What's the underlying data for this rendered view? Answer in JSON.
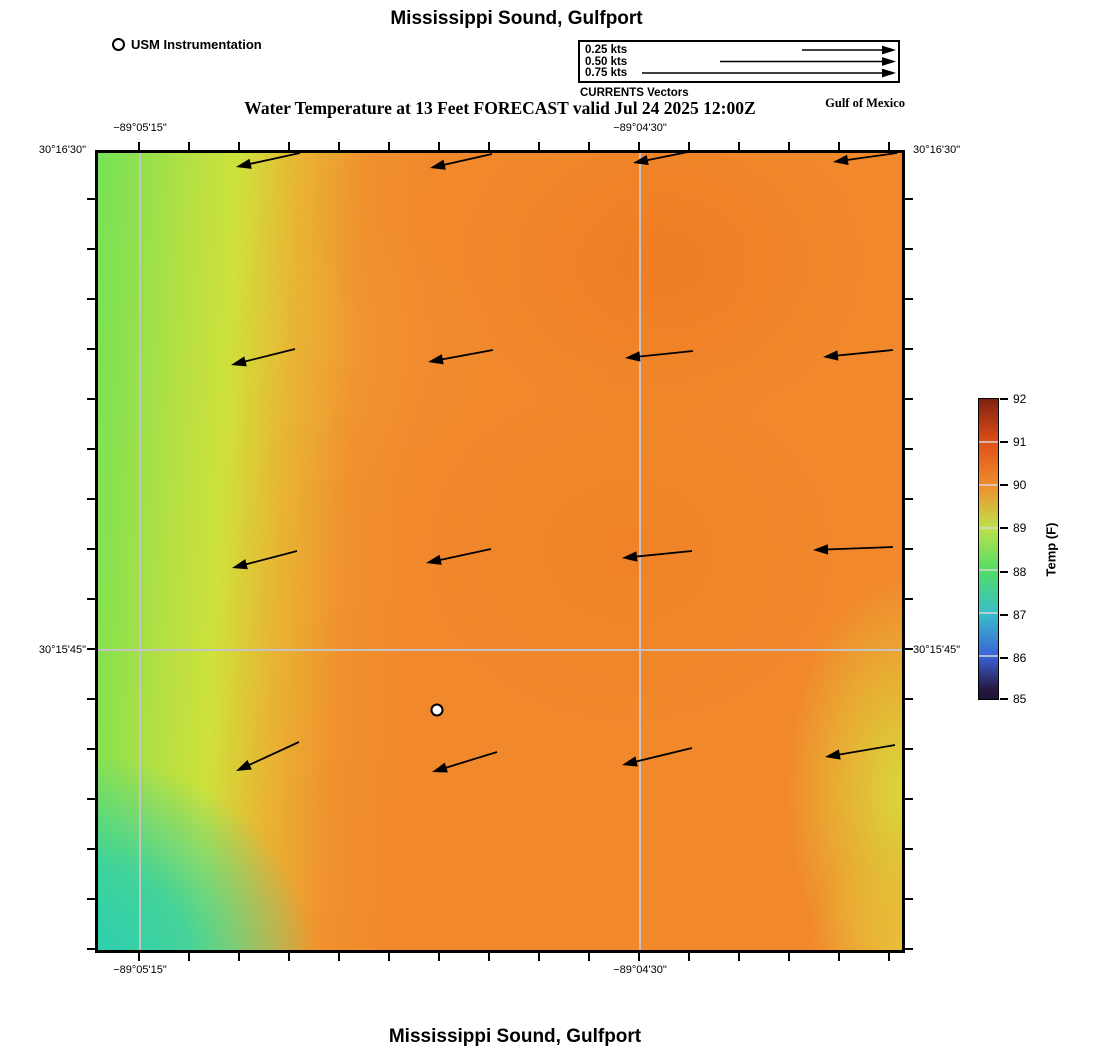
{
  "page": {
    "top_title": "Mississippi Sound, Gulfport",
    "bottom_title": "Mississippi Sound, Gulfport"
  },
  "subtitle": "Water Temperature at 13 Feet FORECAST valid Jul 24 2025 12:00Z",
  "legend": {
    "station_label": "USM Instrumentation",
    "vector_rows": [
      "0.25 kts",
      "0.50 kts",
      "0.75 kts"
    ],
    "caption": "CURRENTS Vectors",
    "region_label": "Gulf of Mexico"
  },
  "axes": {
    "lon_labels": [
      "−89°05'15\"",
      "−89°04'30\""
    ],
    "lat_labels": [
      "30°16'30\"",
      "30°15'45\""
    ]
  },
  "colorbar": {
    "label": "Temp (F)",
    "ticks": [
      "92",
      "91",
      "90",
      "89",
      "88",
      "87",
      "86",
      "85"
    ]
  },
  "chart_data": {
    "type": "heatmap",
    "title": "Mississippi Sound, Gulfport",
    "subtitle": "Water Temperature at 13 Feet FORECAST valid Jul 24 2025 12:00Z",
    "region_label": "Gulf of Mexico",
    "variable": "Water Temperature at 13 Feet",
    "valid_time": "Jul 24 2025 12:00Z",
    "x_axis": {
      "labels": [
        "−89°05'15\"",
        "−89°04'30\""
      ],
      "label_positions_px": [
        45,
        545
      ],
      "extent_px": 810
    },
    "y_axis": {
      "labels": [
        "30°16'30\"",
        "30°15'45\""
      ],
      "label_positions_px": [
        0,
        500
      ],
      "extent_px": 803
    },
    "grid": true,
    "colorbar": {
      "label": "Temp (F)",
      "min": 85,
      "max": 92,
      "tick_values": [
        85,
        86,
        87,
        88,
        89,
        90,
        91,
        92
      ],
      "stop_colors": {
        "85": "#27173f",
        "86": "#3a62d8",
        "87": "#38bfc8",
        "88": "#52dd66",
        "89": "#bfe14a",
        "90": "#f08c2c",
        "91": "#dd4f17",
        "92": "#8e2412"
      },
      "position": "right"
    },
    "field_region_estimates_f": [
      {
        "region": "west_edge",
        "temp_f": 88.6
      },
      {
        "region": "southwest_corner",
        "temp_f": 87.3
      },
      {
        "region": "center",
        "temp_f": 90.1
      },
      {
        "region": "north_center",
        "temp_f": 90.3
      },
      {
        "region": "northeast",
        "temp_f": 90.4
      },
      {
        "region": "southeast_edge",
        "temp_f": 89.2
      },
      {
        "region": "south_center",
        "temp_f": 90.0
      }
    ],
    "vectors": {
      "units": "kts",
      "legend_speeds": [
        0.25,
        0.5,
        0.75
      ],
      "typical_speed_kts": 0.2,
      "mean_direction": "westward (W to WSW)",
      "arrows": [
        {
          "tail": [
            205,
            3
          ],
          "tip": [
            141,
            17
          ]
        },
        {
          "tail": [
            397,
            4
          ],
          "tip": [
            335,
            18
          ]
        },
        {
          "tail": [
            598,
            1
          ],
          "tip": [
            538,
            13
          ]
        },
        {
          "tail": [
            802,
            3
          ],
          "tip": [
            738,
            12
          ]
        },
        {
          "tail": [
            200,
            199
          ],
          "tip": [
            136,
            215
          ]
        },
        {
          "tail": [
            398,
            200
          ],
          "tip": [
            333,
            212
          ]
        },
        {
          "tail": [
            598,
            201
          ],
          "tip": [
            530,
            208
          ]
        },
        {
          "tail": [
            798,
            200
          ],
          "tip": [
            728,
            207
          ]
        },
        {
          "tail": [
            202,
            401
          ],
          "tip": [
            137,
            418
          ]
        },
        {
          "tail": [
            396,
            399
          ],
          "tip": [
            331,
            413
          ]
        },
        {
          "tail": [
            597,
            401
          ],
          "tip": [
            527,
            408
          ]
        },
        {
          "tail": [
            798,
            397
          ],
          "tip": [
            718,
            400
          ]
        },
        {
          "tail": [
            204,
            592
          ],
          "tip": [
            141,
            621
          ]
        },
        {
          "tail": [
            402,
            602
          ],
          "tip": [
            337,
            622
          ]
        },
        {
          "tail": [
            597,
            598
          ],
          "tip": [
            527,
            615
          ]
        },
        {
          "tail": [
            800,
            595
          ],
          "tip": [
            730,
            607
          ]
        }
      ]
    },
    "station": {
      "name": "USM Instrumentation",
      "x_px": 342,
      "y_px": 560
    }
  }
}
